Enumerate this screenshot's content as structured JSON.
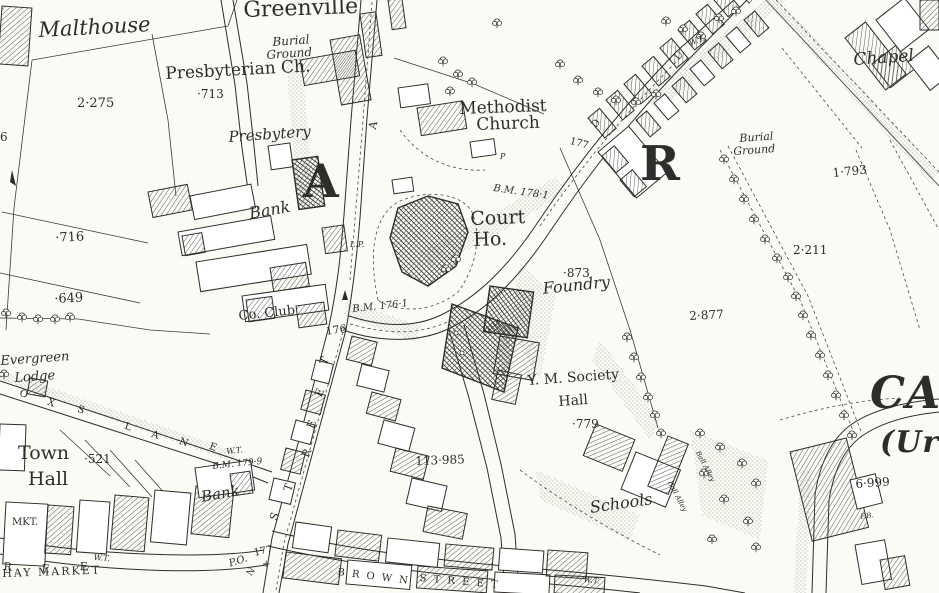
{
  "map": {
    "colors": {
      "ink": "#2f2d2a",
      "paper": "#fbfaf4"
    },
    "labels": [
      {
        "n": "greenville",
        "t": "Greenville",
        "x": 243,
        "y": 0,
        "s": 22,
        "r": -2,
        "st": ""
      },
      {
        "n": "malthouse",
        "t": "Malthouse",
        "x": 38,
        "y": 20,
        "s": 21,
        "r": -3,
        "st": "i"
      },
      {
        "n": "plot-2275",
        "t": "2·275",
        "x": 77,
        "y": 97,
        "s": 13,
        "r": 0,
        "st": ""
      },
      {
        "n": "presbyterian-ch",
        "t": "Presbyterian Ch.",
        "x": 165,
        "y": 66,
        "s": 17,
        "r": -3,
        "st": ""
      },
      {
        "n": "spot-713",
        "t": "·713",
        "x": 197,
        "y": 88,
        "s": 12,
        "r": 0,
        "st": ""
      },
      {
        "n": "burial-ground-west-line1",
        "t": "Burial",
        "x": 272,
        "y": 36,
        "s": 12,
        "r": -4,
        "st": "i"
      },
      {
        "n": "burial-ground-west-line2",
        "t": "Ground",
        "x": 266,
        "y": 49,
        "s": 12,
        "r": -4,
        "st": "i"
      },
      {
        "n": "presbytery",
        "t": "Presbytery",
        "x": 228,
        "y": 130,
        "s": 15,
        "r": -4,
        "st": "i"
      },
      {
        "n": "bank-north",
        "t": "Bank",
        "x": 248,
        "y": 206,
        "s": 16,
        "r": -10,
        "st": "i"
      },
      {
        "n": "spot-716",
        "t": "·716",
        "x": 55,
        "y": 232,
        "s": 13,
        "r": -3,
        "st": ""
      },
      {
        "n": "spot-649",
        "t": "·649",
        "x": 54,
        "y": 293,
        "s": 13,
        "r": -3,
        "st": ""
      },
      {
        "n": "co-club",
        "t": "Co. Club",
        "x": 238,
        "y": 310,
        "s": 13,
        "r": -6,
        "st": ""
      },
      {
        "n": "evergreen",
        "t": "Evergreen",
        "x": 0,
        "y": 355,
        "s": 13,
        "r": -4,
        "st": "i"
      },
      {
        "n": "lodge",
        "t": "Lodge",
        "x": 14,
        "y": 372,
        "s": 13,
        "r": -4,
        "st": "i"
      },
      {
        "n": "town",
        "t": "Town",
        "x": 18,
        "y": 444,
        "s": 19,
        "r": 0,
        "st": ""
      },
      {
        "n": "town-hall",
        "t": "Hall",
        "x": 28,
        "y": 470,
        "s": 19,
        "r": 0,
        "st": ""
      },
      {
        "n": "spot-521",
        "t": "·521",
        "x": 84,
        "y": 453,
        "s": 12,
        "r": 0,
        "st": ""
      },
      {
        "n": "mkt",
        "t": "MKT.",
        "x": 12,
        "y": 518,
        "s": 10,
        "r": 0,
        "st": ""
      },
      {
        "n": "hay-market",
        "t": "HAY MARKET",
        "x": 2,
        "y": 568,
        "s": 11,
        "r": -2,
        "st": "",
        "ls": 2
      },
      {
        "n": "bank-south",
        "t": "Bank",
        "x": 200,
        "y": 490,
        "s": 15,
        "r": -10,
        "st": "i"
      },
      {
        "n": "bm-179-9",
        "t": "B.M. 179·9",
        "x": 212,
        "y": 463,
        "s": 9,
        "r": -6,
        "st": "i"
      },
      {
        "n": "wt-west",
        "t": "W.T.",
        "x": 226,
        "y": 448,
        "s": 8,
        "r": -6,
        "st": "i"
      },
      {
        "n": "spot-176",
        "t": "176",
        "x": 325,
        "y": 326,
        "s": 11,
        "r": -8,
        "st": ""
      },
      {
        "n": "bm-176-1",
        "t": "B.M. 176·1",
        "x": 352,
        "y": 305,
        "s": 10,
        "r": -6,
        "st": "i"
      },
      {
        "n": "lp-mark",
        "t": "L.P.",
        "x": 350,
        "y": 241,
        "s": 8,
        "r": 0,
        "st": "i"
      },
      {
        "n": "district-letter-a",
        "t": "A",
        "x": 303,
        "y": 158,
        "s": 46,
        "r": 0,
        "st": "b"
      },
      {
        "n": "court",
        "t": "Court",
        "x": 470,
        "y": 210,
        "s": 19,
        "r": -2,
        "st": ""
      },
      {
        "n": "court-ho",
        "t": "Ho.",
        "x": 473,
        "y": 231,
        "s": 19,
        "r": -2,
        "st": ""
      },
      {
        "n": "bm-178-1",
        "t": "B.M. 178·1",
        "x": 494,
        "y": 184,
        "s": 10,
        "r": 8,
        "st": "i"
      },
      {
        "n": "methodist",
        "t": "Methodist",
        "x": 459,
        "y": 101,
        "s": 17,
        "r": -2,
        "st": ""
      },
      {
        "n": "methodist-church",
        "t": "Church",
        "x": 476,
        "y": 117,
        "s": 17,
        "r": -2,
        "st": ""
      },
      {
        "n": "road-177-east",
        "t": "177",
        "x": 571,
        "y": 137,
        "s": 10,
        "r": 15,
        "st": ""
      },
      {
        "n": "p-mark",
        "t": "P",
        "x": 500,
        "y": 153,
        "s": 8,
        "r": 0,
        "st": "i"
      },
      {
        "n": "spot-873",
        "t": "·873",
        "x": 563,
        "y": 267,
        "s": 12,
        "r": 0,
        "st": ""
      },
      {
        "n": "foundry",
        "t": "Foundry",
        "x": 542,
        "y": 281,
        "s": 16,
        "r": -6,
        "st": "i"
      },
      {
        "n": "plot-2877",
        "t": "2·877",
        "x": 689,
        "y": 310,
        "s": 12,
        "r": -3,
        "st": ""
      },
      {
        "n": "district-letter-r",
        "t": "R",
        "x": 640,
        "y": 140,
        "s": 48,
        "r": 0,
        "st": "b"
      },
      {
        "n": "burial-ground-east-line1",
        "t": "Burial",
        "x": 739,
        "y": 133,
        "s": 11,
        "r": -4,
        "st": "i"
      },
      {
        "n": "burial-ground-east-line2",
        "t": "Ground",
        "x": 733,
        "y": 146,
        "s": 11,
        "r": -4,
        "st": "i"
      },
      {
        "n": "chapel",
        "t": "Chapel",
        "x": 853,
        "y": 52,
        "s": 17,
        "r": -4,
        "st": "i"
      },
      {
        "n": "plot-1793",
        "t": "1·793",
        "x": 832,
        "y": 167,
        "s": 12,
        "r": -6,
        "st": ""
      },
      {
        "n": "plot-2211",
        "t": "2·211",
        "x": 793,
        "y": 244,
        "s": 12,
        "r": 0,
        "st": ""
      },
      {
        "n": "wt-north",
        "t": "W.T.",
        "x": 688,
        "y": 40,
        "s": 8,
        "r": -20,
        "st": "i"
      },
      {
        "n": "street-letter-d",
        "t": "D",
        "x": 590,
        "y": 124,
        "s": 10,
        "r": -48,
        "st": ""
      },
      {
        "n": "street-letter-u",
        "t": "U",
        "x": 673,
        "y": 56,
        "s": 10,
        "r": -48,
        "st": ""
      },
      {
        "n": "street-letter-b",
        "t": "B",
        "x": 743,
        "y": 0,
        "s": 10,
        "r": -48,
        "st": ""
      },
      {
        "n": "ym-society",
        "t": "Y. M. Society",
        "x": 527,
        "y": 374,
        "s": 14,
        "r": -4,
        "st": ""
      },
      {
        "n": "ym-hall",
        "t": "Hall",
        "x": 558,
        "y": 395,
        "s": 14,
        "r": -4,
        "st": ""
      },
      {
        "n": "spot-779",
        "t": "·779",
        "x": 572,
        "y": 418,
        "s": 12,
        "r": 0,
        "st": ""
      },
      {
        "n": "plot-113985",
        "t": "113·985",
        "x": 415,
        "y": 455,
        "s": 12,
        "r": -2,
        "st": ""
      },
      {
        "n": "schools",
        "t": "Schools",
        "x": 589,
        "y": 500,
        "s": 16,
        "r": -8,
        "st": "i"
      },
      {
        "n": "ball-alley-1",
        "t": "Ball Alley",
        "x": 700,
        "y": 450,
        "s": 7,
        "r": 62,
        "st": "i"
      },
      {
        "n": "ball-alley-2",
        "t": "Ball Alley",
        "x": 672,
        "y": 480,
        "s": 7,
        "r": 62,
        "st": "i"
      },
      {
        "n": "district-letters-ca",
        "t": "CA",
        "x": 870,
        "y": 372,
        "s": 44,
        "r": 0,
        "st": "b i"
      },
      {
        "n": "district-letters-ur",
        "t": "(Ur",
        "x": 880,
        "y": 428,
        "s": 30,
        "r": 0,
        "st": "b i"
      },
      {
        "n": "plot-6999",
        "t": "6·999",
        "x": 855,
        "y": 478,
        "s": 12,
        "r": -4,
        "st": ""
      },
      {
        "n": "fb-mark",
        "t": "F.B.",
        "x": 860,
        "y": 514,
        "s": 7,
        "r": -8,
        "st": "i"
      },
      {
        "n": "road-177-south",
        "t": "177",
        "x": 253,
        "y": 549,
        "s": 10,
        "r": -12,
        "st": ""
      },
      {
        "n": "post-office",
        "t": "P.O.",
        "x": 228,
        "y": 560,
        "s": 10,
        "r": -18,
        "st": "i"
      },
      {
        "n": "boundary-cross",
        "t": "+",
        "x": 262,
        "y": 560,
        "s": 10,
        "r": 0,
        "st": ""
      },
      {
        "n": "street-letter-n",
        "t": "N",
        "x": 246,
        "y": 573,
        "s": 9,
        "r": -55,
        "st": ""
      },
      {
        "n": "street-letter-r2",
        "t": "R",
        "x": 4,
        "y": 561,
        "s": 11,
        "r": 5,
        "st": ""
      },
      {
        "n": "street-letter-e2",
        "t": "E",
        "x": 42,
        "y": 563,
        "s": 11,
        "r": 5,
        "st": ""
      },
      {
        "n": "street-letter-e3",
        "t": "E",
        "x": 80,
        "y": 561,
        "s": 11,
        "r": 3,
        "st": ""
      },
      {
        "n": "wt-southwest",
        "t": "W.T.",
        "x": 94,
        "y": 554,
        "s": 8,
        "r": 3,
        "st": "i"
      },
      {
        "n": "brown-street-word1",
        "t": "B R O W N",
        "x": 338,
        "y": 568,
        "s": 10,
        "r": 7,
        "st": "",
        "ls": 2
      },
      {
        "n": "brown-street-word2",
        "t": "S T R E E T",
        "x": 420,
        "y": 574,
        "s": 10,
        "r": 5,
        "st": "",
        "ls": 2
      },
      {
        "n": "wt-southeast",
        "t": "W.T.",
        "x": 584,
        "y": 576,
        "s": 8,
        "r": 6,
        "st": "i"
      },
      {
        "n": "main-street-letter-t1",
        "t": "T",
        "x": 318,
        "y": 362,
        "s": 11,
        "r": -65,
        "st": ""
      },
      {
        "n": "main-street-letter-e1",
        "t": "E",
        "x": 313,
        "y": 394,
        "s": 11,
        "r": -65,
        "st": ""
      },
      {
        "n": "main-street-letter-e2",
        "t": "E",
        "x": 305,
        "y": 426,
        "s": 11,
        "r": -68,
        "st": ""
      },
      {
        "n": "main-street-letter-r",
        "t": "R",
        "x": 300,
        "y": 455,
        "s": 11,
        "r": -68,
        "st": ""
      },
      {
        "n": "main-street-letter-t2",
        "t": "T",
        "x": 282,
        "y": 489,
        "s": 11,
        "r": -70,
        "st": ""
      },
      {
        "n": "main-street-letter-s",
        "t": "S",
        "x": 268,
        "y": 518,
        "s": 11,
        "r": -70,
        "st": ""
      },
      {
        "n": "lane-letter-o",
        "t": "O",
        "x": 21,
        "y": 389,
        "s": 10,
        "r": 18,
        "st": ""
      },
      {
        "n": "lane-letter-x",
        "t": "X",
        "x": 49,
        "y": 398,
        "s": 10,
        "r": 18,
        "st": ""
      },
      {
        "n": "lane-letter-s",
        "t": "S",
        "x": 79,
        "y": 405,
        "s": 10,
        "r": 18,
        "st": ""
      },
      {
        "n": "lane-letter-l",
        "t": "L",
        "x": 126,
        "y": 422,
        "s": 10,
        "r": 18,
        "st": ""
      },
      {
        "n": "lane-letter-a",
        "t": "A",
        "x": 153,
        "y": 430,
        "s": 10,
        "r": 18,
        "st": ""
      },
      {
        "n": "lane-letter-n",
        "t": "N",
        "x": 181,
        "y": 437,
        "s": 10,
        "r": 20,
        "st": ""
      },
      {
        "n": "lane-letter-e",
        "t": "E",
        "x": 211,
        "y": 442,
        "s": 10,
        "r": 20,
        "st": ""
      },
      {
        "n": "north-street-letter-a",
        "t": "A",
        "x": 367,
        "y": 128,
        "s": 11,
        "r": -78,
        "st": ""
      },
      {
        "n": "edge-number-6",
        "t": "6",
        "x": 0,
        "y": 131,
        "s": 12,
        "r": 0,
        "st": ""
      },
      {
        "n": "x-mark",
        "t": "x",
        "x": 342,
        "y": 325,
        "s": 8,
        "r": 0,
        "st": ""
      }
    ]
  }
}
